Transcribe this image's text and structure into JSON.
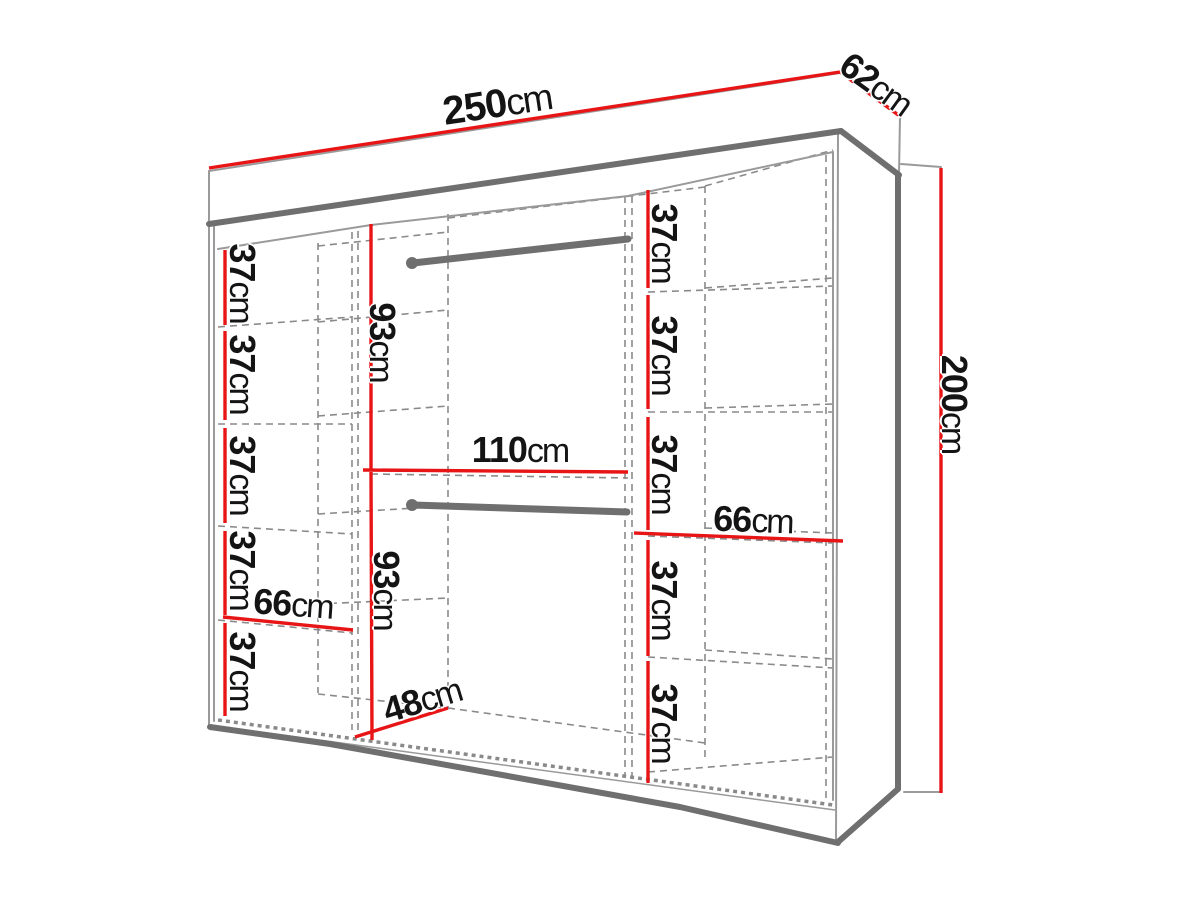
{
  "title": "Wardrobe dimension diagram",
  "units": "cm",
  "colors": {
    "dimension_line": "#e81517",
    "outline_gray": "#6f6f6f",
    "dashed_gray": "#8a8a8a",
    "label_text": "#141414",
    "background": "#ffffff"
  },
  "overall_dimensions": {
    "width_cm": 250,
    "depth_cm": 62,
    "height_cm": 200
  },
  "sections": {
    "left_column": {
      "shelf_gap_heights_cm": [
        37,
        37,
        37,
        37,
        37
      ],
      "shelf_width_cm": 66
    },
    "middle_section": {
      "upper_hanging_height_cm": 93,
      "lower_hanging_height_cm": 93,
      "width_cm": 110,
      "floor_depth_cm": 48,
      "hanging_rails": 2
    },
    "right_column": {
      "shelf_gap_heights_cm": [
        37,
        37,
        37,
        37,
        37
      ],
      "shelf_width_cm": 66
    }
  },
  "labels": {
    "width": {
      "num": "250",
      "unit": "cm"
    },
    "depth": {
      "num": "62",
      "unit": "cm"
    },
    "height": {
      "num": "200",
      "unit": "cm"
    },
    "left37a": {
      "num": "37",
      "unit": "cm"
    },
    "left37b": {
      "num": "37",
      "unit": "cm"
    },
    "left37c": {
      "num": "37",
      "unit": "cm"
    },
    "left37d": {
      "num": "37",
      "unit": "cm"
    },
    "left37e": {
      "num": "37",
      "unit": "cm"
    },
    "left66": {
      "num": "66",
      "unit": "cm"
    },
    "mid93top": {
      "num": "93",
      "unit": "cm"
    },
    "mid110": {
      "num": "110",
      "unit": "cm"
    },
    "mid93bot": {
      "num": "93",
      "unit": "cm"
    },
    "mid48": {
      "num": "48",
      "unit": "cm"
    },
    "right37a": {
      "num": "37",
      "unit": "cm"
    },
    "right37b": {
      "num": "37",
      "unit": "cm"
    },
    "right37c": {
      "num": "37",
      "unit": "cm"
    },
    "right37d": {
      "num": "37",
      "unit": "cm"
    },
    "right37e": {
      "num": "37",
      "unit": "cm"
    },
    "right66": {
      "num": "66",
      "unit": "cm"
    }
  }
}
